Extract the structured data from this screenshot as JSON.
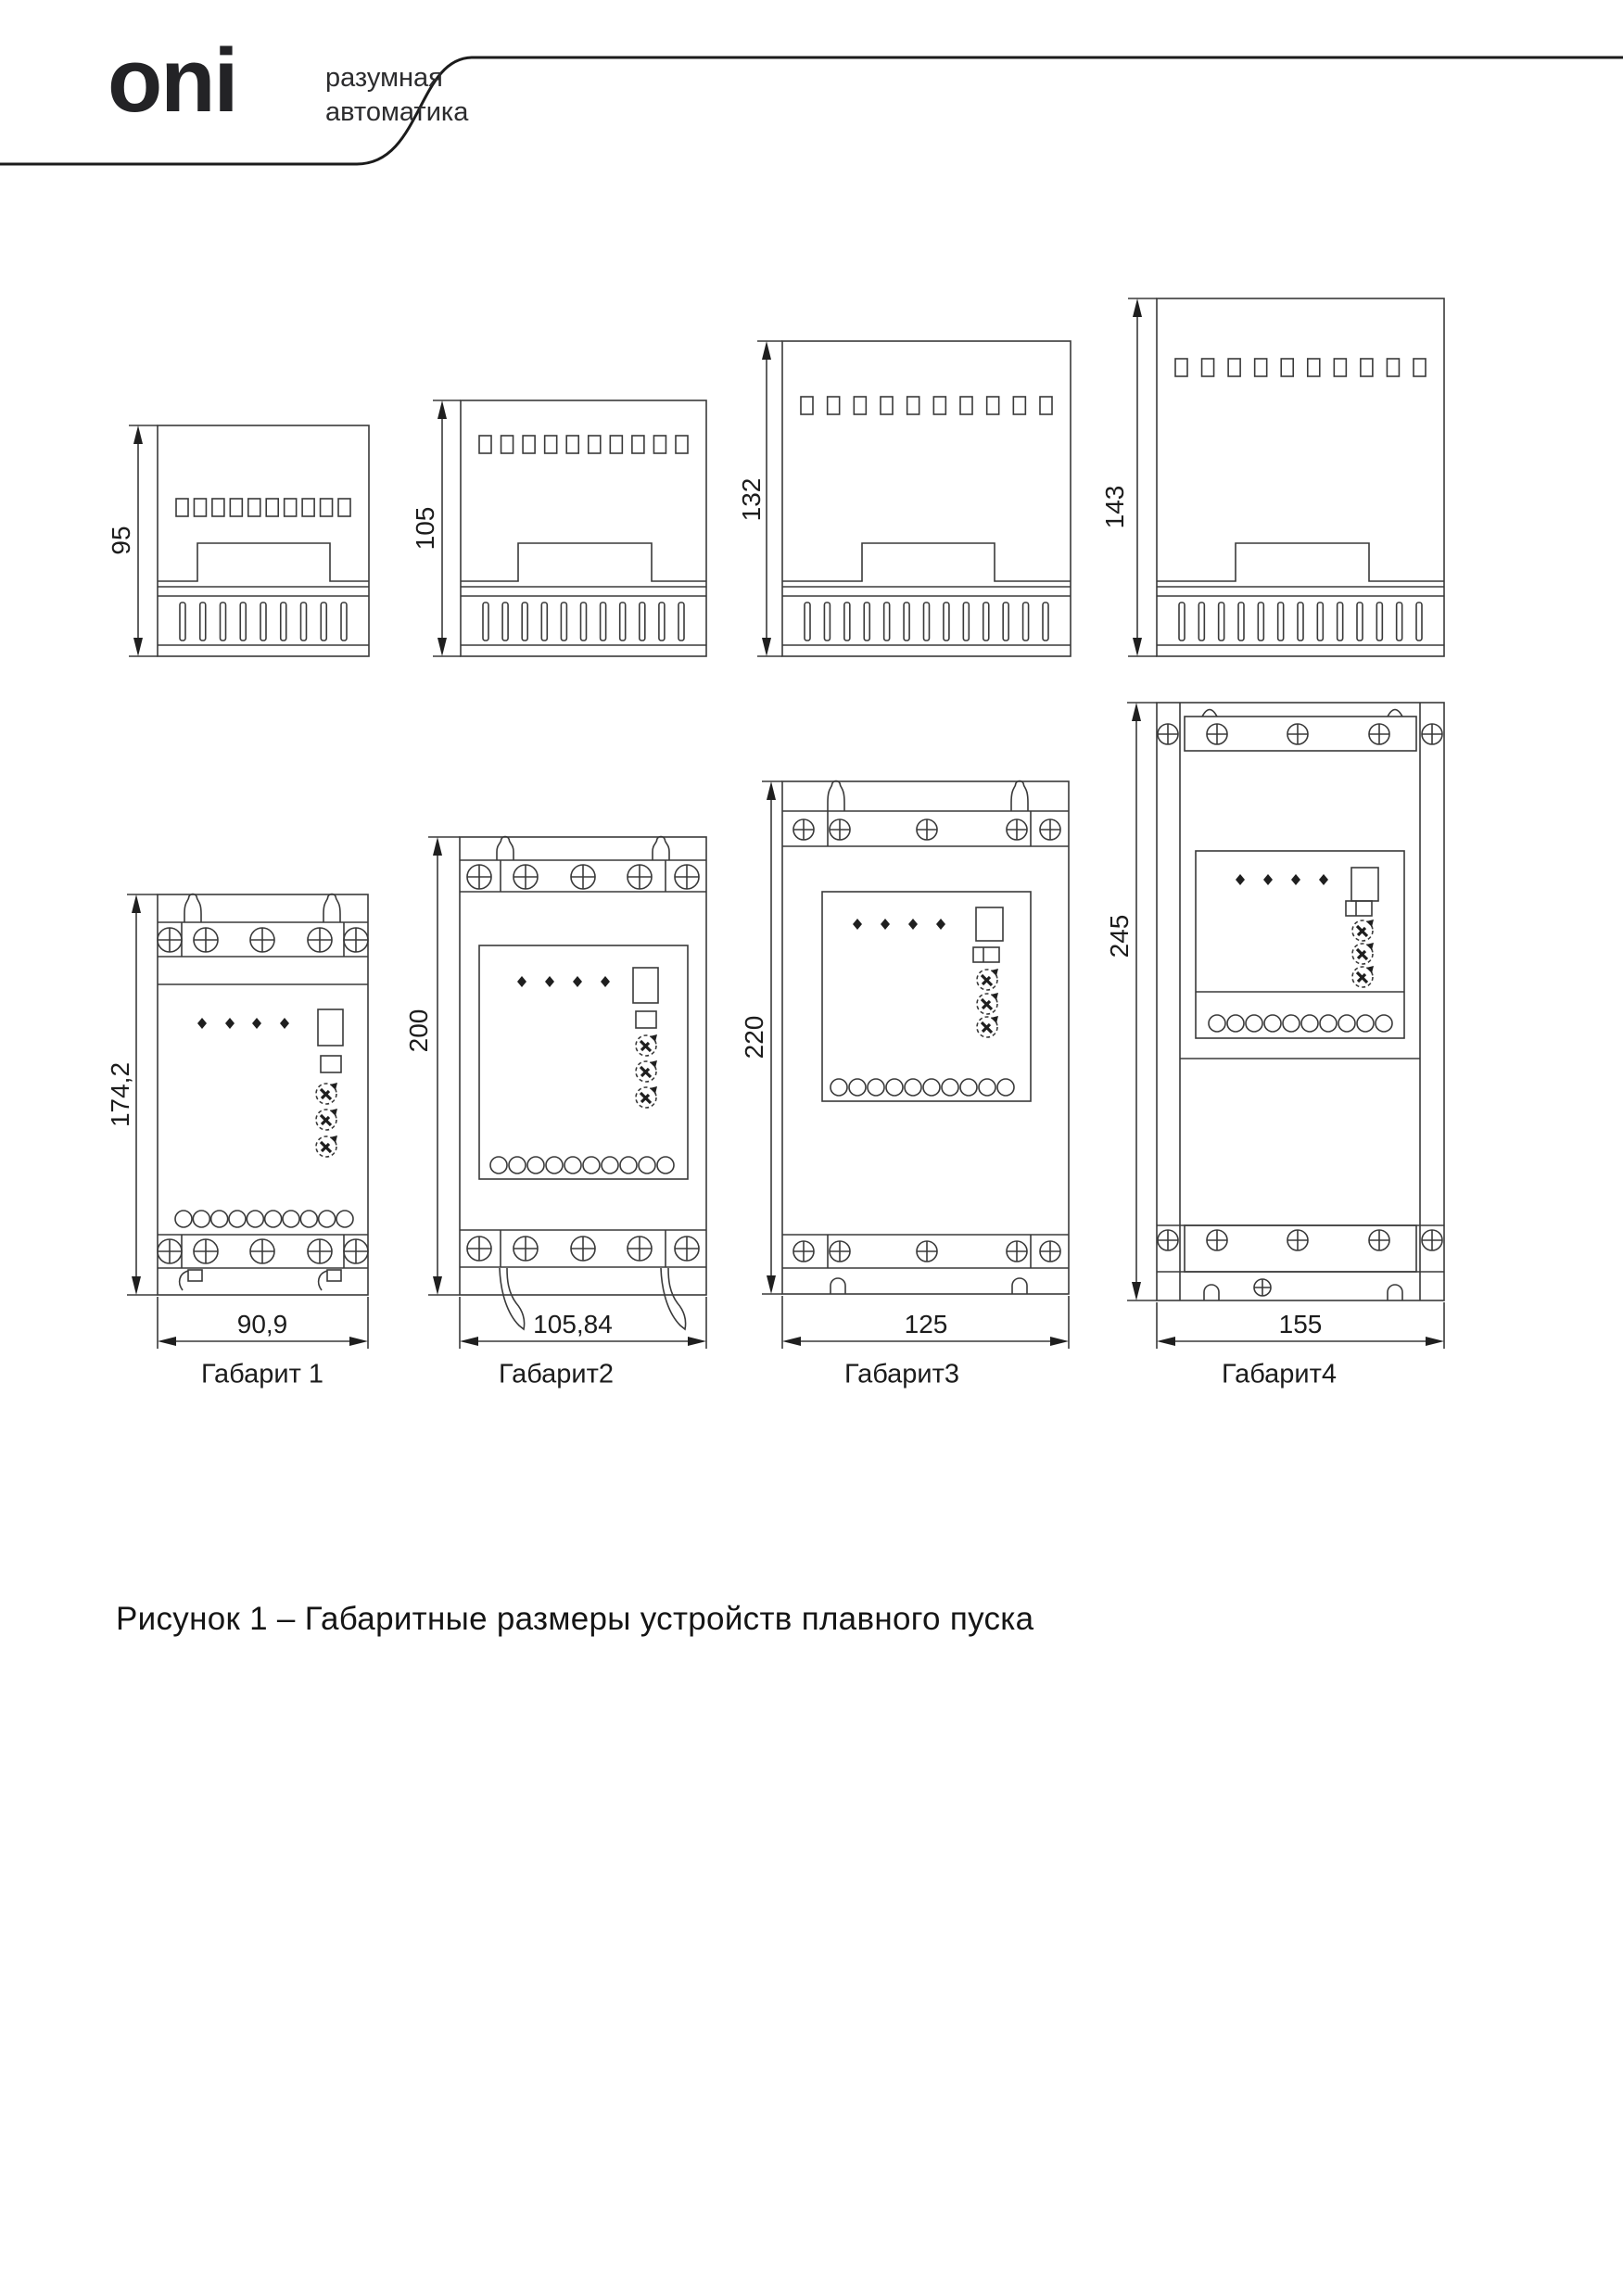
{
  "header": {
    "logo": "oni",
    "tagline_line1": "разумная",
    "tagline_line2": "автоматика"
  },
  "figure": {
    "caption": "Рисунок 1 – Габаритные размеры устройств плавного пуска",
    "frames": [
      {
        "name": "Габарит 1",
        "side_height": "95",
        "front_height": "174,2",
        "width": "90,9"
      },
      {
        "name": "Габарит2",
        "side_height": "105",
        "front_height": "200",
        "width": "105,84"
      },
      {
        "name": "Габарит3",
        "side_height": "132",
        "front_height": "220",
        "width": "125"
      },
      {
        "name": "Габарит4",
        "side_height": "143",
        "front_height": "245",
        "width": "155"
      }
    ]
  },
  "colors": {
    "line": "#3a3a3a",
    "dim": "#1f1f1f",
    "text": "#151515"
  }
}
